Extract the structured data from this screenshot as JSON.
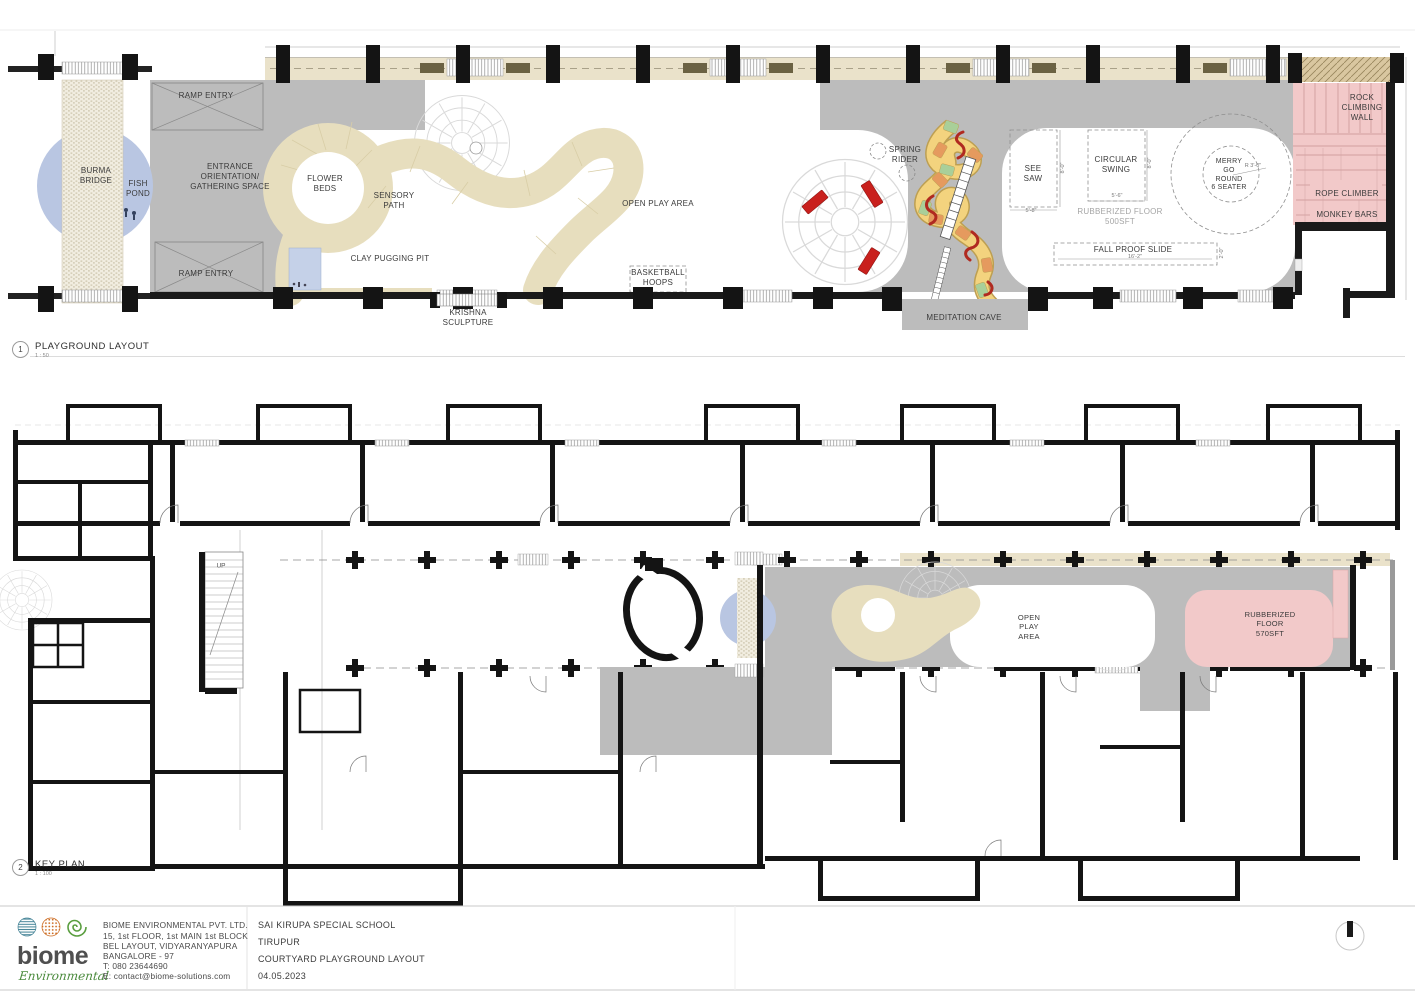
{
  "drawing1": {
    "number": "1",
    "title": "PLAYGROUND LAYOUT",
    "scale": "1 : 50",
    "labels": {
      "burma_bridge": "BURMA\nBRIDGE",
      "fish_pond": "FISH\nPOND",
      "ramp_entry_top": "RAMP ENTRY",
      "ramp_entry_bottom": "RAMP ENTRY",
      "entrance": "ENTRANCE\nORIENTATION/\nGATHERING SPACE",
      "flower_beds": "FLOWER\nBEDS",
      "sensory_path": "SENSORY\nPATH",
      "clay_pugging_pit": "CLAY PUGGING PIT",
      "krishna_sculpture": "KRISHNA\nSCULPTURE",
      "open_play_area": "OPEN PLAY AREA",
      "basketball_hoops": "BASKETBALL\nHOOPS",
      "spring_rider": "SPRING\nRIDER",
      "meditation_cave": "MEDITATION CAVE",
      "see_saw": "SEE\nSAW",
      "circular_swing": "CIRCULAR\nSWING",
      "rubberized_floor": "RUBBERIZED FLOOR\n500SFT",
      "fall_proof_slide": "FALL PROOF SLIDE",
      "merry_go_round": "MERRY\nGO\nROUND\n6 SEATER",
      "rock_climbing_wall": "ROCK\nCLIMBING\nWALL",
      "rope_climber": "ROPE CLIMBER",
      "monkey_bars": "MONKEY BARS"
    },
    "dimensions": {
      "see_saw_w": "5'-8\"",
      "see_saw_h": "8'-0\"",
      "circular_swing_w": "5'-6\"",
      "circular_swing_h": "8'-0\"",
      "fall_proof_slide_l": "16'-2\"",
      "fall_proof_slide_w": "2'-0\"",
      "merry_go_round_r": "R 3'-0\""
    }
  },
  "drawing2": {
    "number": "2",
    "title": "KEY PLAN",
    "scale": "1 : 100",
    "labels": {
      "up": "UP",
      "open_play_area": "OPEN\nPLAY\nAREA",
      "rubberized_floor": "RUBBERIZED\nFLOOR\n570SFT"
    }
  },
  "title_block": {
    "logo": {
      "word": "biome",
      "script": "Environmental"
    },
    "company": {
      "name": "BIOME  ENVIRONMENTAL PVT. LTD.",
      "address1": "15, 1st FLOOR, 1st MAIN 1st BLOCK",
      "address2": "BEL LAYOUT, VIDYARANYAPURA",
      "address3": "BANGALORE - 97",
      "phone": "T: 080 23644690",
      "email": "E: contact@biome-solutions.com"
    },
    "project": {
      "client": "SAI KIRUPA SPECIAL SCHOOL",
      "location": "TIRUPUR",
      "sheet_title": "COURTYARD PLAYGROUND LAYOUT",
      "date": "04.05.2023"
    }
  },
  "colors": {
    "courtyard_gray": "#bcbcbc",
    "verandah_tan": "#eae2ca",
    "path_tan": "#e7debe",
    "pond_blue": "#b9c6e2",
    "rubber_pink": "#f2c9c9",
    "bench_red": "#c9201d",
    "slide_yellow": "#f3d37e",
    "slide_orange": "#e59a5e",
    "slide_green": "#a9cf99"
  }
}
